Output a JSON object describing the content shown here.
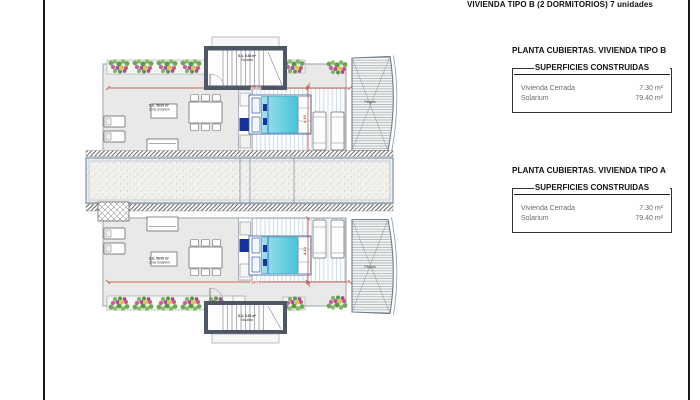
{
  "title": "VIVIENDA TIPO B (2 DORMITORIOS) 7 unidades",
  "panels": [
    {
      "title": "PLANTA CUBIERTAS. VIVIENDA TIPO B",
      "subtitle": "SUPERFICIES CONSTRUIDAS",
      "rows": [
        {
          "label": "Vivienda Cerrada",
          "value": "7.30 m²"
        },
        {
          "label": "Solarium",
          "value": "79.40 m²"
        }
      ]
    },
    {
      "title": "PLANTA CUBIERTAS. VIVIENDA TIPO A",
      "subtitle": "SUPERFICIES CONSTRUIDAS",
      "rows": [
        {
          "label": "Vivienda Cerrada",
          "value": "7.30 m²"
        },
        {
          "label": "Solarium",
          "value": "79.40 m²"
        }
      ]
    }
  ],
  "plan": {
    "units": [
      {
        "name": "unit-top",
        "area_line1": "S.U. 58.05 m²",
        "area_line2": "Zona Solarium",
        "stair_line1": "S.U. 5.30 m²",
        "stair_line2": "Escalera",
        "width_dim": "19.70",
        "height_dim": "4.10",
        "pergola_label": "Pérgola"
      },
      {
        "name": "unit-bottom",
        "area_line1": "S.U. 58.05 m²",
        "area_line2": "Zona Solarium",
        "stair_line1": "S.U. 5.30 m²",
        "stair_line2": "Escalera",
        "width_dim": "19.70",
        "height_dim": "4.10",
        "pergola_label": "Pérgola"
      }
    ]
  },
  "colors": {
    "dimension_red": "#c23a2e",
    "wall_dark": "#4f5665",
    "bed_cyan": "#49c3d8",
    "terrace_gray": "#e9e9e7",
    "plant_green": "#6fa653",
    "line_blue": "#6e86a8"
  }
}
